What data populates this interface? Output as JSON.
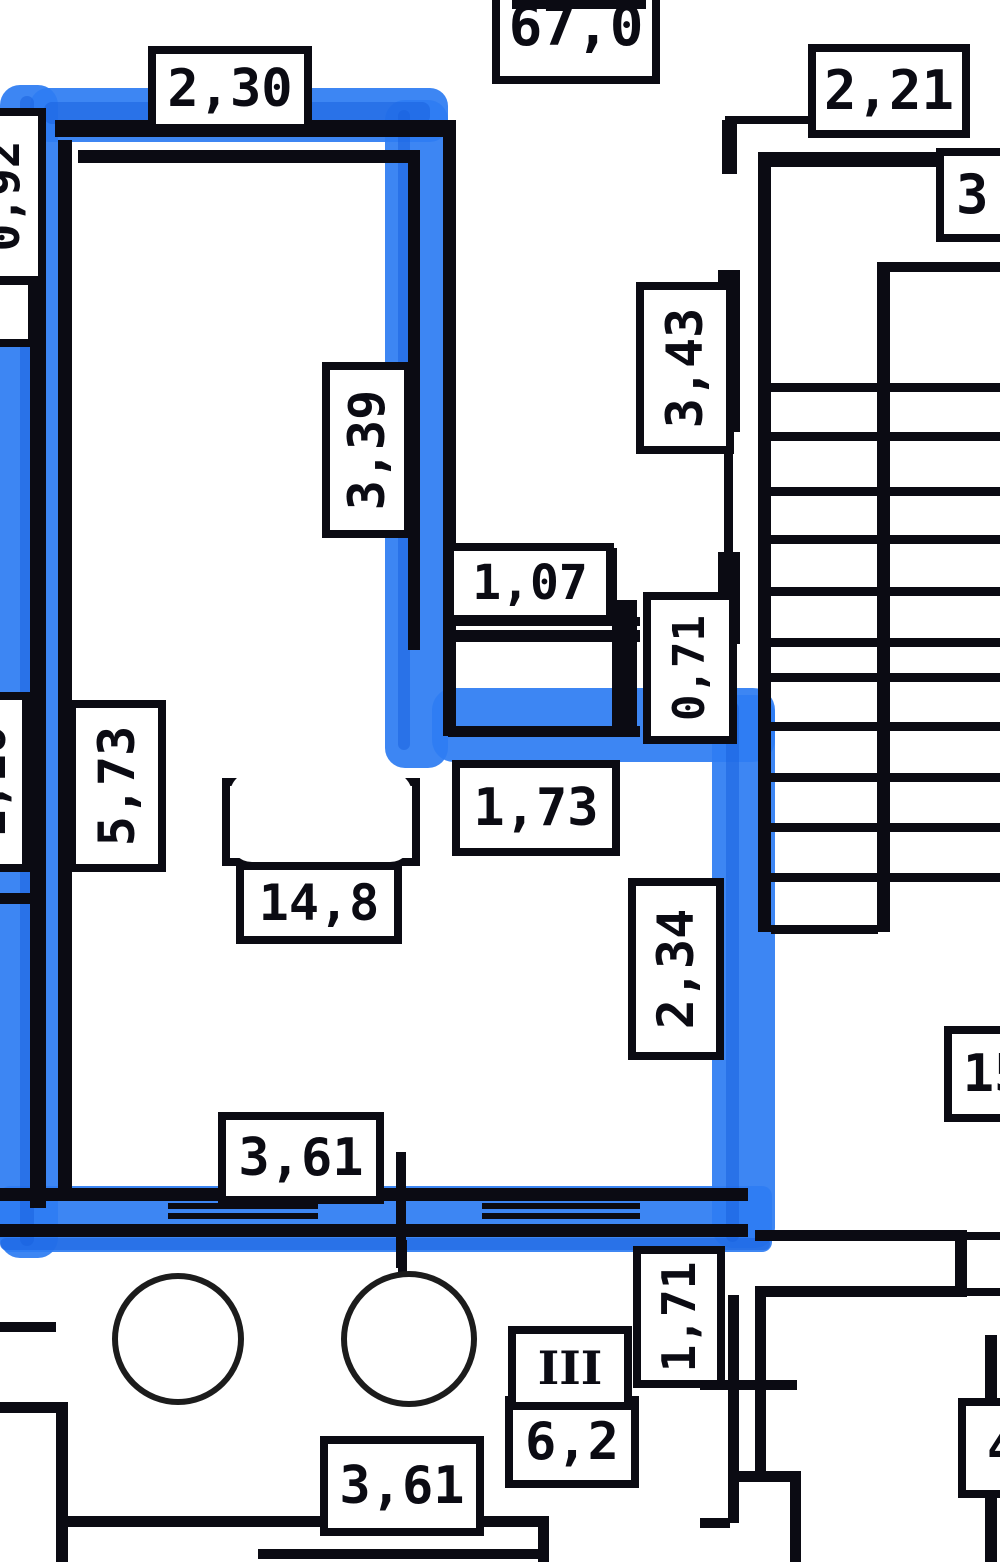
{
  "drawing": {
    "kind": "apartment floor plan with highlighted room outline",
    "colors": {
      "highlight": "#2e7df2",
      "highlight_dark": "#1a63de",
      "wall": "#0b0b13"
    }
  },
  "labels": {
    "total_area": {
      "text": "67,0",
      "clipped": "top"
    },
    "top_width": {
      "text": "2,30"
    },
    "stair_width": {
      "text": "2,21"
    },
    "right_edge_partial": {
      "text": "3",
      "clipped": "right"
    },
    "left_edge_top_partial": {
      "text": "0,92",
      "clipped": "left"
    },
    "left_edge_mid_partial": {
      "text": "1,16",
      "clipped": "left"
    },
    "room_height": {
      "text": "5,73"
    },
    "upper_wall_height": {
      "text": "3,39"
    },
    "niche_width": {
      "text": "1,07"
    },
    "niche_depth": {
      "text": "0,71"
    },
    "stair_run": {
      "text": "3,43"
    },
    "mid_wall_width": {
      "text": "1,73"
    },
    "room_area": {
      "text": "14,8"
    },
    "lower_wall_height": {
      "text": "2,34"
    },
    "bottom_width": {
      "text": "3,61"
    },
    "landing_partial": {
      "text": "15",
      "clipped": "right"
    },
    "balcony_width": {
      "text": "3,61"
    },
    "balcony_area": {
      "text": "6,2"
    },
    "balcony_number": {
      "text": "III"
    },
    "balcony_depth": {
      "text": "1,71"
    },
    "bottom_right_partial": {
      "text": "4",
      "clipped": "right"
    }
  }
}
